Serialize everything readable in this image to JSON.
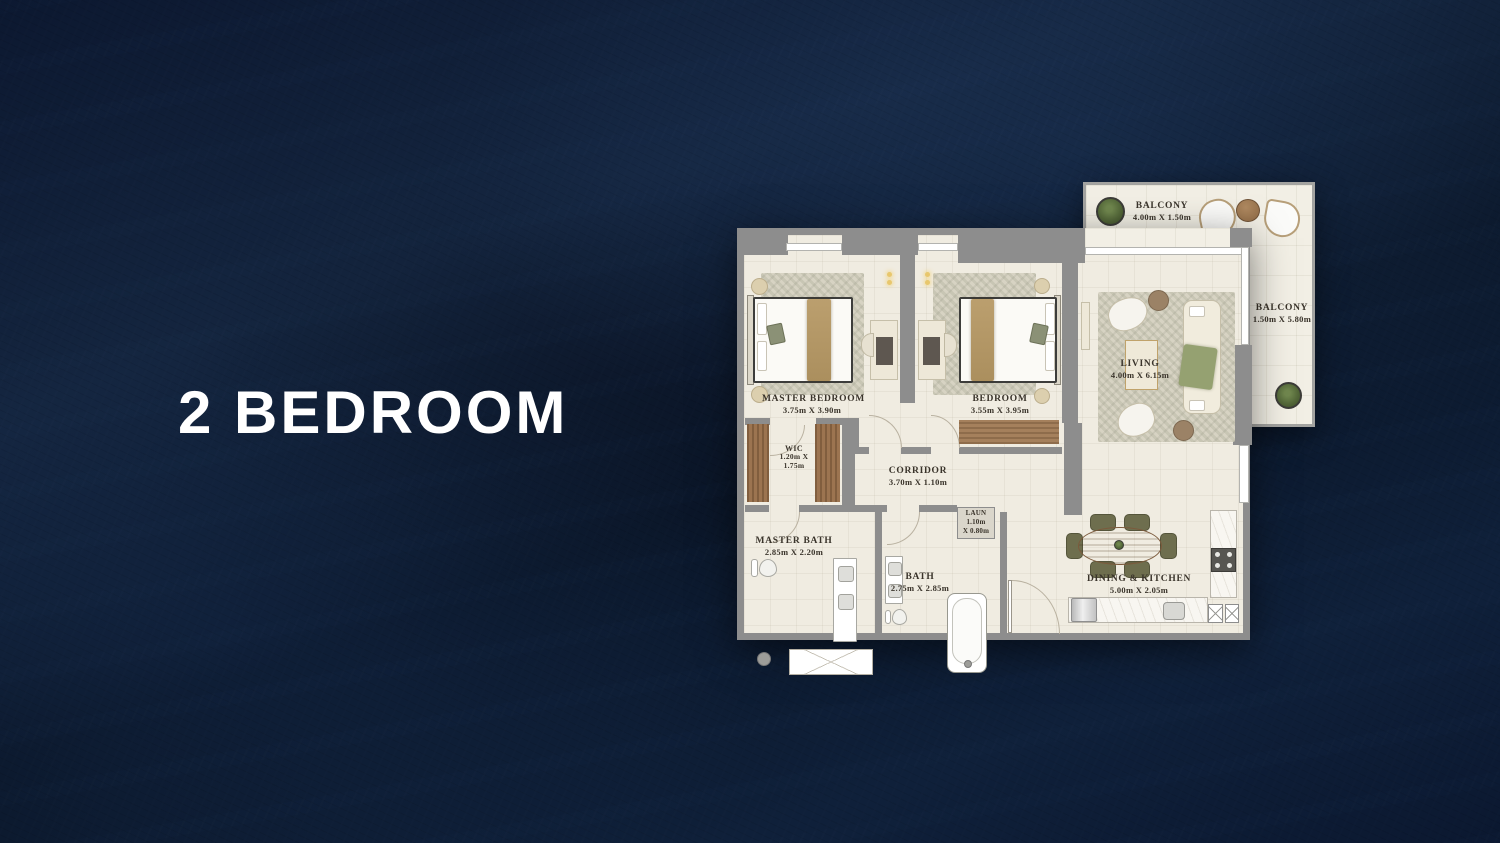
{
  "title": "2 BEDROOM",
  "colors": {
    "background_navy": "#0e1c33",
    "wall_gray": "#8d8d8d",
    "floor_cream": "#f0ece1",
    "wood": "#9c7450",
    "label_ink": "#3a342b",
    "title_white": "#ffffff"
  },
  "plan": {
    "master_bedroom": {
      "name": "MASTER BEDROOM",
      "dims": "3.75m X 3.90m"
    },
    "bedroom": {
      "name": "BEDROOM",
      "dims": "3.55m X 3.95m"
    },
    "living": {
      "name": "LIVING",
      "dims": "4.00m X 6.15m"
    },
    "balcony_top": {
      "name": "BALCONY",
      "dims": "4.00m X 1.50m"
    },
    "balcony_side": {
      "name": "BALCONY",
      "dims": "1.50m X 5.80m"
    },
    "wic": {
      "name": "WIC",
      "dims_line1": "1.20m X",
      "dims_line2": "1.75m"
    },
    "corridor": {
      "name": "CORRIDOR",
      "dims": "3.70m X 1.10m"
    },
    "master_bath": {
      "name": "MASTER BATH",
      "dims": "2.85m X 2.20m"
    },
    "bath": {
      "name": "BATH",
      "dims": "2.75m X 2.85m"
    },
    "laundry": {
      "name": "LAUN",
      "dims_line1": "1.10m",
      "dims_line2": "X 0.80m"
    },
    "dining_kitchen": {
      "name": "DINING & KITCHEN",
      "dims": "5.00m X 2.05m"
    }
  }
}
